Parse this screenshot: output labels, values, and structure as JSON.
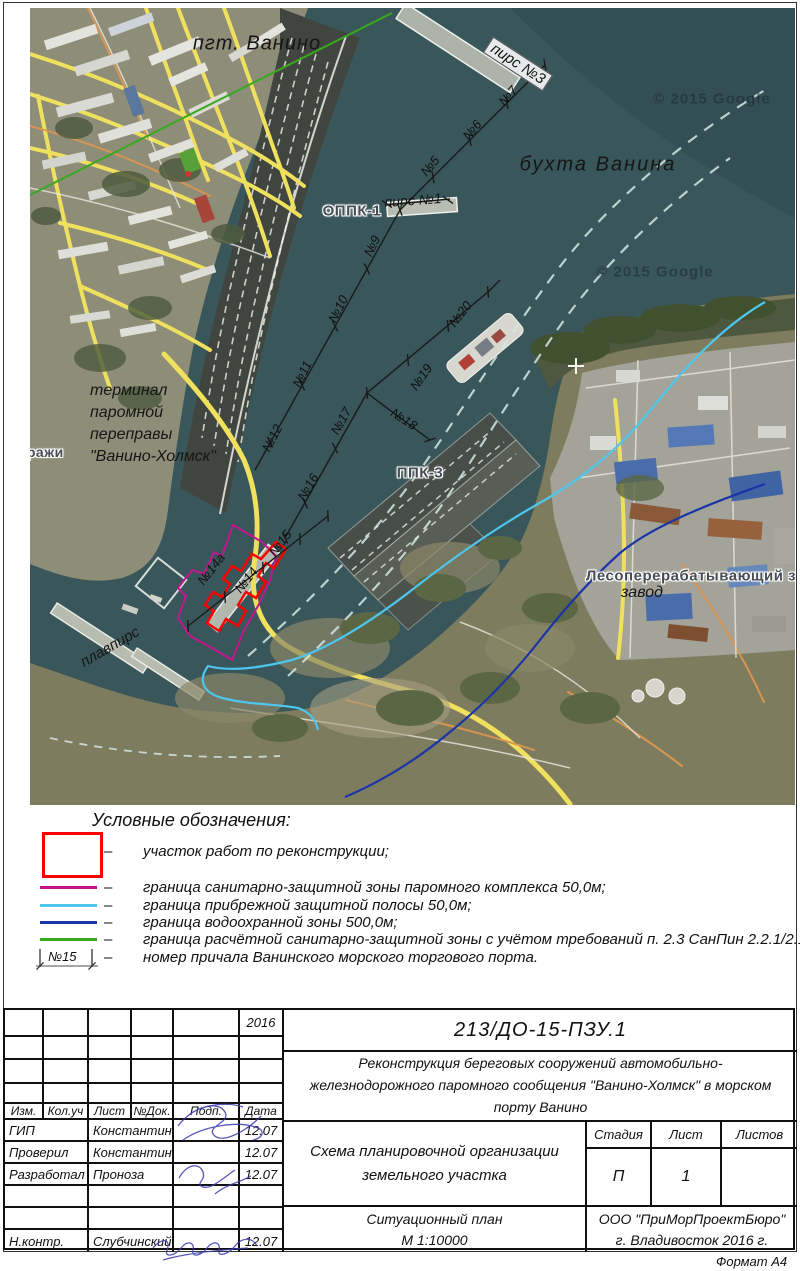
{
  "document": {
    "format_note": "Формат А4"
  },
  "map": {
    "copyright": "© 2015 Google",
    "labels": {
      "town": "пгт. Ванино",
      "bay": "бухта Ванина",
      "pier3": "пирс №3",
      "pier1": "пирс №1",
      "oppk1": "ОППК-1",
      "ppk3": "ППК-3",
      "terminal_line1": "терминал",
      "terminal_line2": "паромной",
      "terminal_line3": "переправы",
      "terminal_line4": "\"Ванино-Холмск\"",
      "garages": "гаражи",
      "floating_pier": "плавпирс",
      "sawmill": "Лесоперерабатывающий з",
      "sawmill2": "завод"
    },
    "berth_numbers": [
      "№7",
      "№6",
      "№5",
      "№9",
      "№10",
      "№11",
      "№12",
      "№15",
      "№14",
      "№14а",
      "№16",
      "№17",
      "№18",
      "№19",
      "№20"
    ]
  },
  "legend": {
    "title": "Условные обозначения:",
    "dash": "–",
    "items": [
      {
        "type": "area",
        "color": "#ff0000",
        "text": "участок работ по реконструкции;"
      },
      {
        "type": "line",
        "color": "#c2188f",
        "text": "граница санитарно-защитной зоны паромного комплекса 50,0м;"
      },
      {
        "type": "line",
        "color": "#4ec7ee",
        "text": "граница прибрежной защитной полосы 50,0м;"
      },
      {
        "type": "line",
        "color": "#1b35a6",
        "text": "граница водоохранной зоны 500,0м;"
      },
      {
        "type": "line",
        "color": "#3aa81e",
        "text": "граница расчётной санитарно-защитной зоны с учётом требований п. 2.3 СанПин 2.2.1/2.1.1.200-03;"
      },
      {
        "type": "berth-symbol",
        "label": "№15",
        "text": "номер причала Ванинского морского торгового порта."
      }
    ]
  },
  "title_block": {
    "year": "2016",
    "code": "213/ДО-15-ПЗУ.1",
    "project": "Реконструкция береговых сооружений автомобильно-железнодорожного паромного сообщения \"Ванино-Холмск\" в морском порту Ванино",
    "drawing_title": "Схема планировочной организации земельного участка",
    "view_line1": "Ситуационный план",
    "view_line2": "М 1:10000",
    "columns": [
      "Изм.",
      "Кол.уч",
      "Лист",
      "№Док.",
      "Подп.",
      "Дата"
    ],
    "stage_label": "Стадия",
    "sheet_label": "Лист",
    "sheets_label": "Листов",
    "stage": "П",
    "sheet": "1",
    "sheets": "",
    "staff": [
      {
        "role": "ГИП",
        "name": "Константинов",
        "date": "12.07"
      },
      {
        "role": "Проверил",
        "name": "Константинов",
        "date": "12.07"
      },
      {
        "role": "Разработал",
        "name": "Проноза",
        "date": "12.07"
      },
      {
        "role": "",
        "name": "",
        "date": ""
      },
      {
        "role": "",
        "name": "",
        "date": ""
      },
      {
        "role": "Н.контр.",
        "name": "Слубчинский",
        "date": "12.07"
      }
    ],
    "company_line1": "ООО \"ПриМорПроектБюро\"",
    "company_line2": "г. Владивосток 2016 г."
  }
}
